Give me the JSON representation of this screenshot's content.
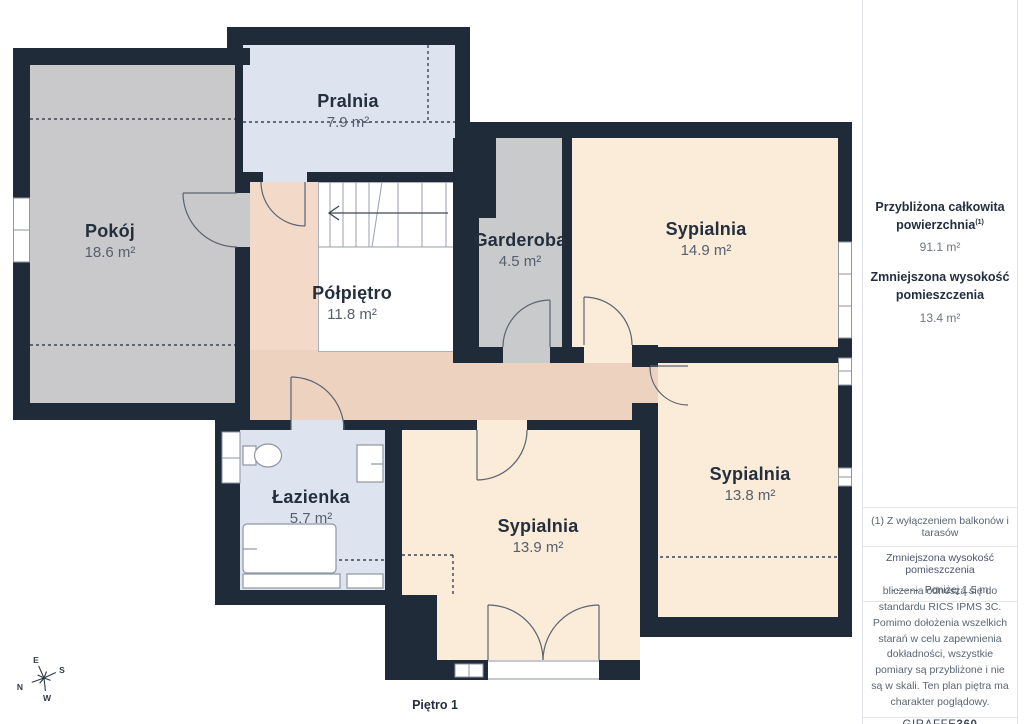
{
  "floorplan": {
    "title": "Piętro 1",
    "rooms": [
      {
        "name": "Pokój",
        "area": "18.6 m²"
      },
      {
        "name": "Pralnia",
        "area": "7.9 m²"
      },
      {
        "name": "Półpiętro",
        "area": "11.8 m²"
      },
      {
        "name": "Garderoba",
        "area": "4.5 m²"
      },
      {
        "name": "Sypialnia",
        "area": "14.9 m²"
      },
      {
        "name": "Sypialnia",
        "area": "13.8 m²"
      },
      {
        "name": "Sypialnia",
        "area": "13.9 m²"
      },
      {
        "name": "Łazienka",
        "area": "5.7 m²"
      }
    ],
    "compass": {
      "n": "N",
      "e": "E",
      "s": "S",
      "w": "W"
    }
  },
  "sidebar": {
    "total_area_label": "Przybliżona całkowita powierzchnia",
    "total_area_sup": "(1)",
    "total_area_value": "91.1 m²",
    "reduced_height_label": "Zmniejszona wysokość pomieszczenia",
    "reduced_height_value": "13.4 m²",
    "footnote": "(1) Z wyłączeniem balkonów i tarasów",
    "legend_title": "Zmniejszona wysokość pomieszczenia",
    "legend_value": "Poniżej 1.5 m",
    "disclaimer": "bliczenia odnoszą się do standardu RICS IPMS 3C. Pomimo dołożenia wszelkich starań w celu zapewnienia dokładności, wszystkie pomiary są przybliżone i nie są w skali. Ten plan piętra ma charakter poglądowy.",
    "brand_name": "GIRAFFE",
    "brand_suffix": "360"
  },
  "colors": {
    "wall": "#202b39",
    "bedroom_floor": "#fbebd9",
    "hall_floor": "#f3d9c8",
    "corridor_floor": "#edd2c0",
    "wet_floor": "#dde3ef",
    "gray_floor": "#c9c9cb",
    "label_dark": "#242f3e",
    "label_gray": "#565f6d"
  }
}
